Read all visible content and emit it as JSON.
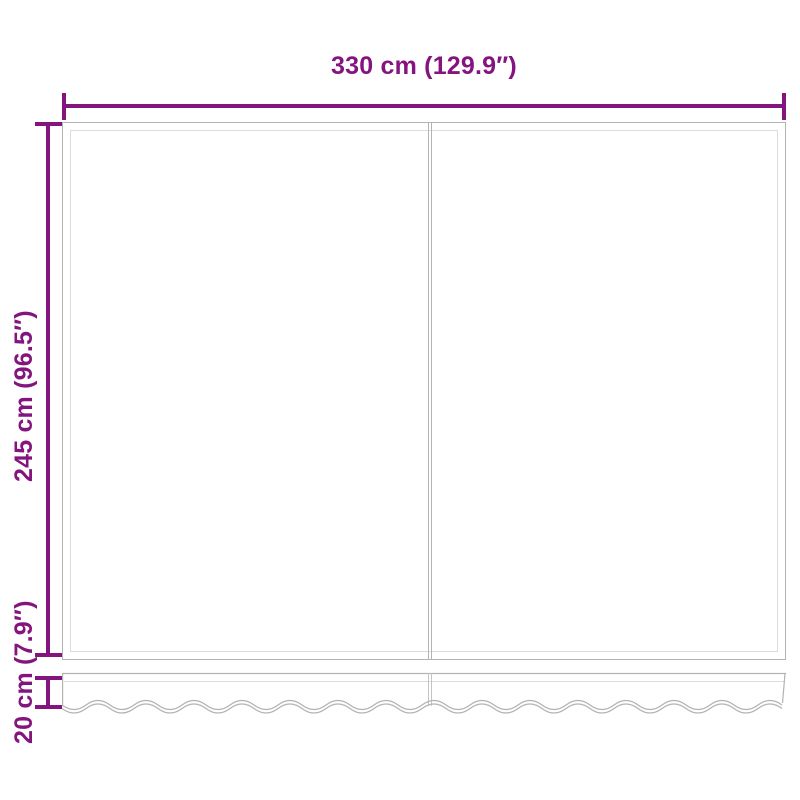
{
  "diagram": {
    "width_label": "330 cm (129.9″)",
    "height_label": "245 cm (96.5″)",
    "valance_label": "20 cm (7.9″)",
    "colors": {
      "dimension": "#84147E",
      "outline": "#b3b3b3",
      "outline_inner": "#dcdcdc"
    }
  }
}
